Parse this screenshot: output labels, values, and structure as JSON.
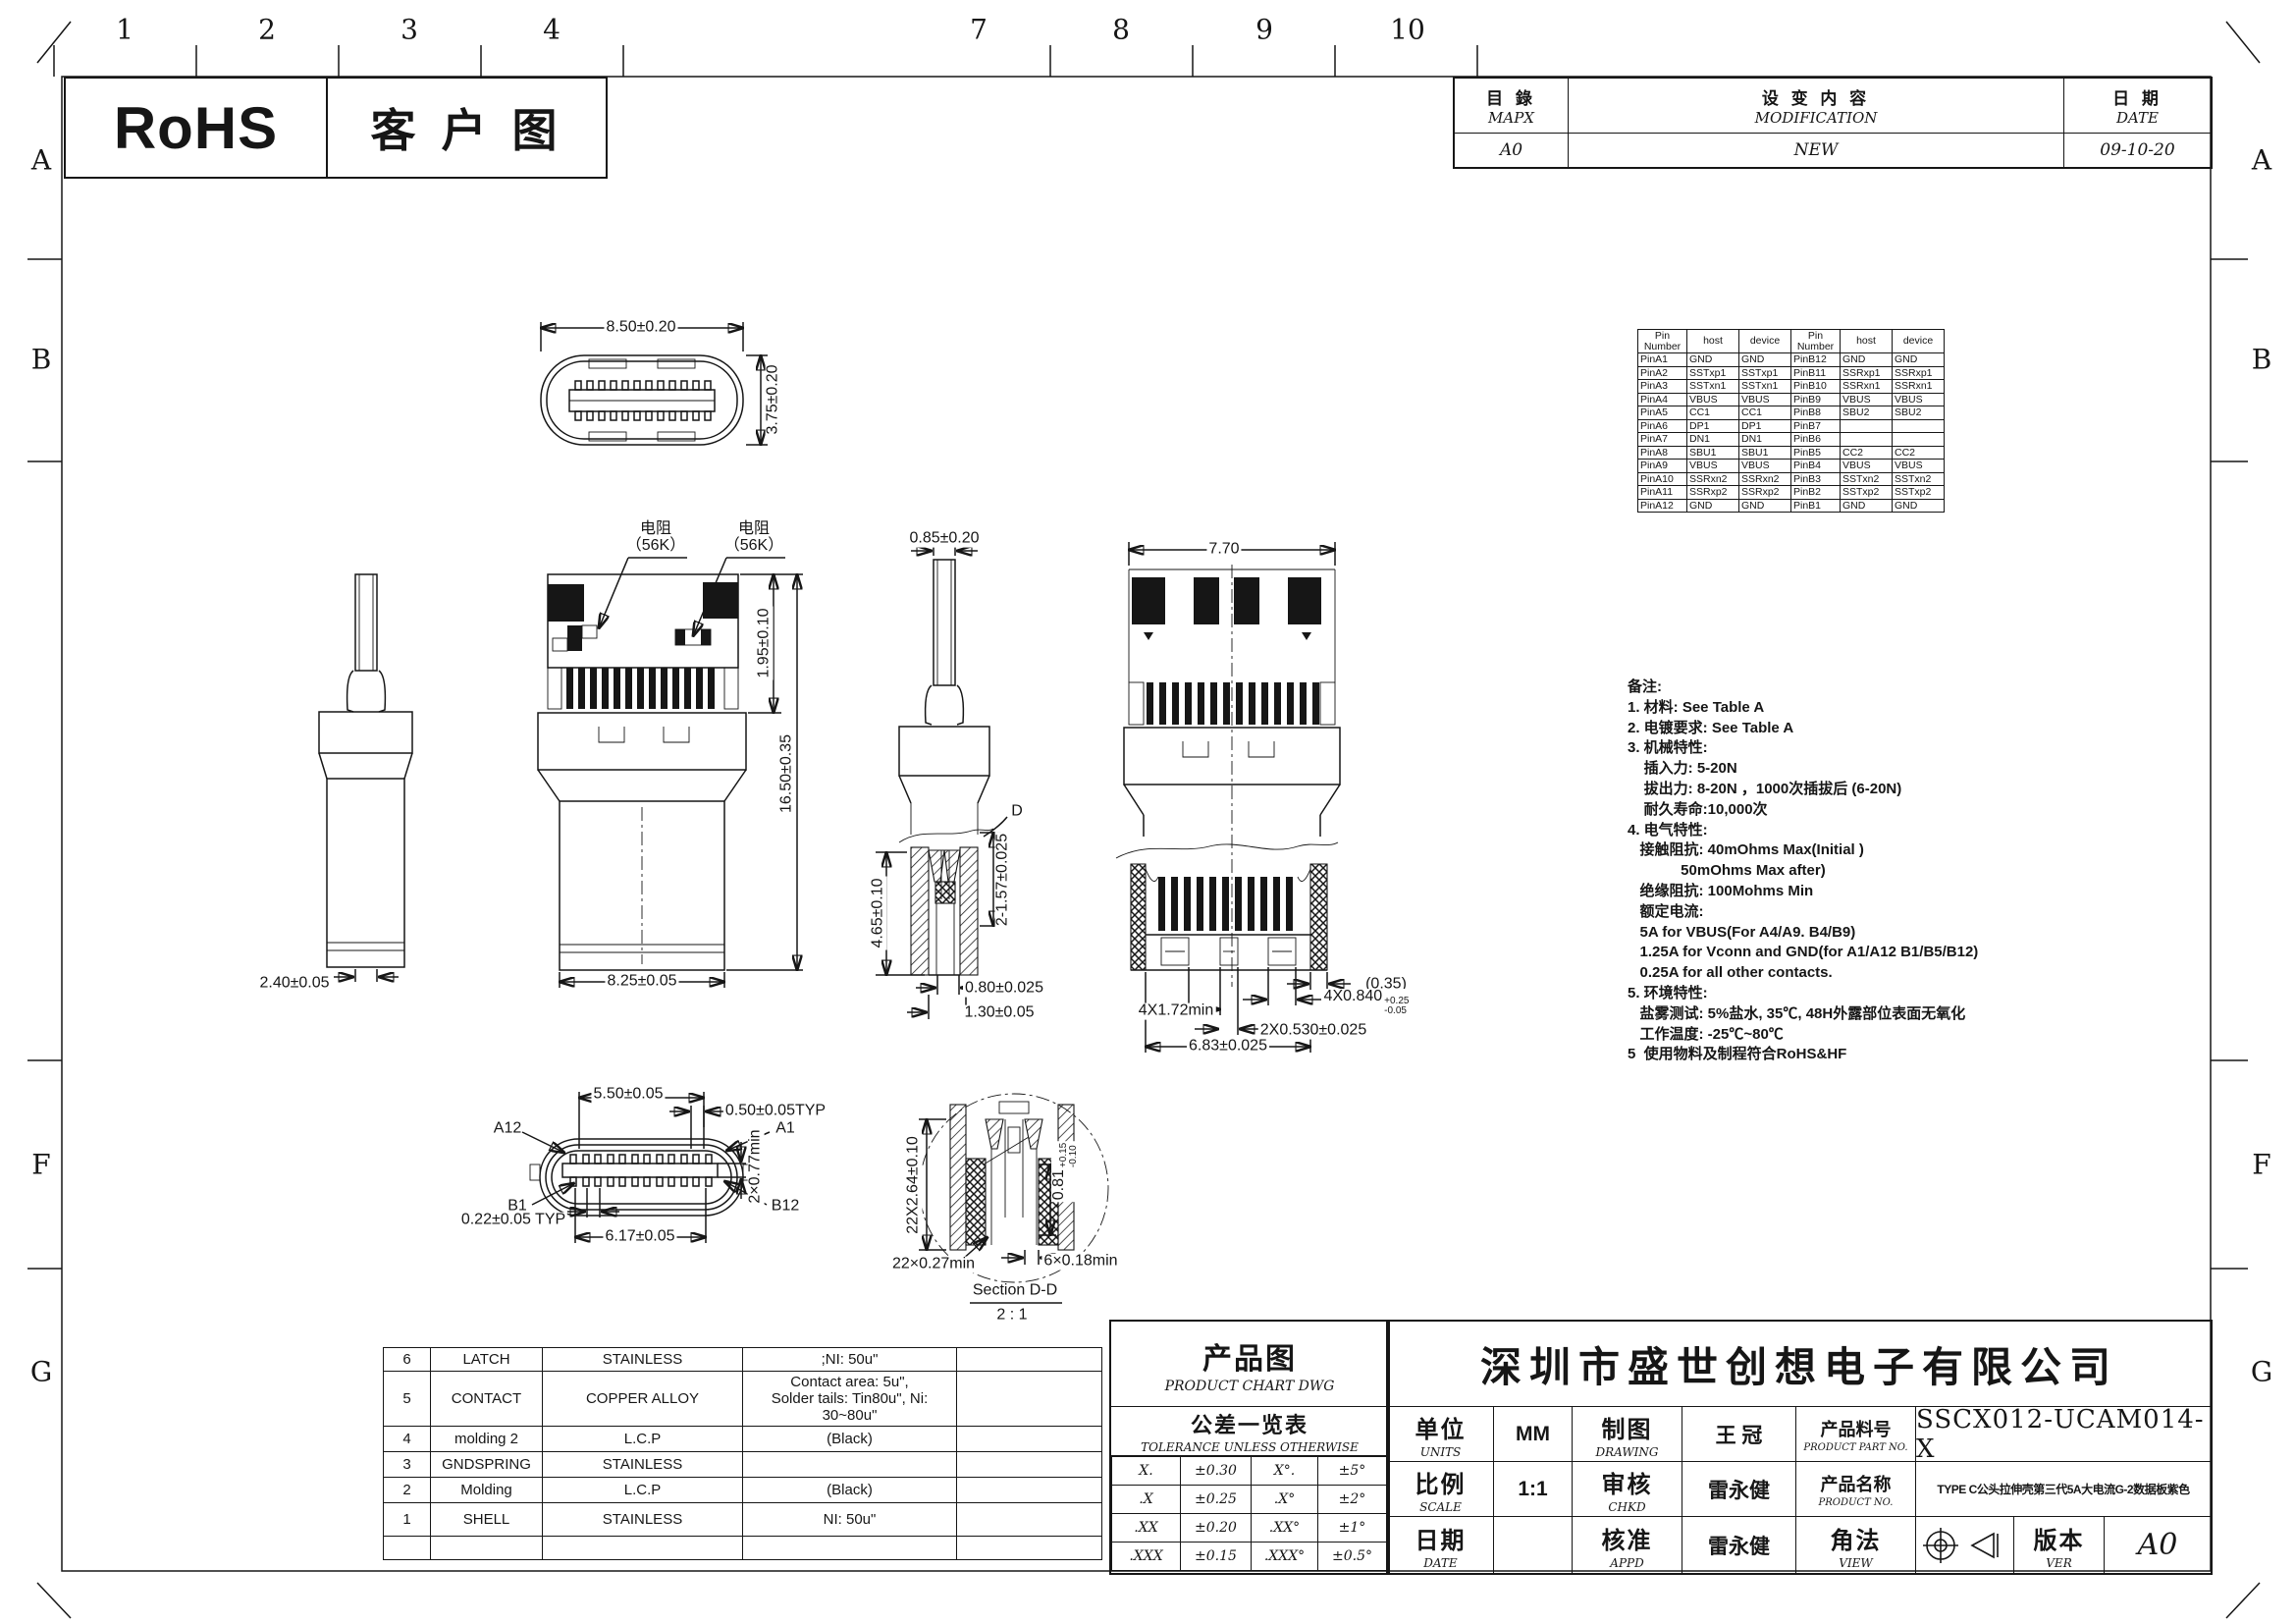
{
  "header": {
    "rohs": "RoHS",
    "customer_drawing": "客户图"
  },
  "ruler": {
    "top": [
      "1",
      "2",
      "3",
      "4",
      "7",
      "8",
      "9",
      "10"
    ],
    "left": [
      "A",
      "B",
      "F",
      "G"
    ],
    "right": [
      "A",
      "B",
      "F",
      "G"
    ]
  },
  "mod_table": {
    "cols": [
      {
        "zh": "目 錄",
        "en": "MAPX"
      },
      {
        "zh": "设 变 内 容",
        "en": "MODIFICATION"
      },
      {
        "zh": "日 期",
        "en": "DATE"
      }
    ],
    "row": [
      "A0",
      "NEW",
      "09-10-20"
    ]
  },
  "pin_table": {
    "headers": [
      "Pin\nNumber",
      "host",
      "device",
      "Pin\nNumber",
      "host",
      "device"
    ],
    "rows": [
      [
        "PinA1",
        "GND",
        "GND",
        "PinB12",
        "GND",
        "GND"
      ],
      [
        "PinA2",
        "SSTxp1",
        "SSTxp1",
        "PinB11",
        "SSRxp1",
        "SSRxp1"
      ],
      [
        "PinA3",
        "SSTxn1",
        "SSTxn1",
        "PinB10",
        "SSRxn1",
        "SSRxn1"
      ],
      [
        "PinA4",
        "VBUS",
        "VBUS",
        "PinB9",
        "VBUS",
        "VBUS"
      ],
      [
        "PinA5",
        "CC1",
        "CC1",
        "PinB8",
        "SBU2",
        "SBU2"
      ],
      [
        "PinA6",
        "DP1",
        "DP1",
        "PinB7",
        "",
        ""
      ],
      [
        "PinA7",
        "DN1",
        "DN1",
        "PinB6",
        "",
        ""
      ],
      [
        "PinA8",
        "SBU1",
        "SBU1",
        "PinB5",
        "CC2",
        "CC2"
      ],
      [
        "PinA9",
        "VBUS",
        "VBUS",
        "PinB4",
        "VBUS",
        "VBUS"
      ],
      [
        "PinA10",
        "SSRxn2",
        "SSRxn2",
        "PinB3",
        "SSTxn2",
        "SSTxn2"
      ],
      [
        "PinA11",
        "SSRxp2",
        "SSRxp2",
        "PinB2",
        "SSTxp2",
        "SSTxp2"
      ],
      [
        "PinA12",
        "GND",
        "GND",
        "PinB1",
        "GND",
        "GND"
      ]
    ]
  },
  "notes": {
    "lines": [
      "备注:",
      "1. 材料: See Table A",
      "2. 电镀要求: See Table A",
      "3. 机械特性:",
      "    插入力: 5-20N",
      "    拔出力: 8-20N ，1000次插拔后 (6-20N)",
      "    耐久寿命:10,000次",
      "4. 电气特性:",
      "   接触阻抗: 40mOhms Max(Initial )",
      "             50mOhms Max after)",
      "   绝缘阻抗: 100Mohms Min",
      "   额定电流:",
      "   5A for VBUS(For A4/A9. B4/B9)",
      "   1.25A for Vconn and GND(for A1/A12 B1/B5/B12)",
      "   0.25A for all other contacts.",
      "5. 环境特性:",
      "   盐雾测试: 5%盐水, 35℃, 48H外露部位表面无氧化",
      "   工作温度: -25℃~80℃",
      "5  使用物料及制程符合RoHS&HF"
    ]
  },
  "dims": {
    "a_w": "8.50±0.20",
    "a_h": "3.75±0.20",
    "res_zh": "电阻",
    "res_val": "（56K）",
    "c_pcb": "1.95±0.10",
    "c_total": "16.50±0.35",
    "b_w": "2.40±0.05",
    "c_w": "8.25±0.05",
    "d_stem": "0.85±0.20",
    "e_w": "7.70",
    "d_callout": "D",
    "d_h": "4.65±0.10",
    "d_h2": "2-1.57±0.025",
    "d_w1": "0.80±0.025",
    "d_w2": "1.30±0.05",
    "f_035": "(0.35)",
    "f_0840": "4X0.840",
    "f_0840_sup": "+0.25",
    "f_0840_sub": "-0.05",
    "f_172": "4X1.72min",
    "f_0530": "2X0.530±0.025",
    "f_683": "6.83±0.025",
    "g_550": "5.50±0.05",
    "g_050": "0.50±0.05TYP",
    "g_077": "2×0.77min",
    "g_022": "0.22±0.05 TYP",
    "g_617": "6.17±0.05",
    "pin_a12": "A12",
    "pin_a1": "A1",
    "pin_b1": "B1",
    "pin_b12": "B12",
    "h_264": "22X2.64±0.10",
    "h_081": "0.81",
    "h_081_sup": "+0.15",
    "h_081_sub": "-0.10",
    "h_027": "22×0.27min",
    "h_018": "6×0.18min",
    "section_label": "Section D-D",
    "section_scale": "2 : 1"
  },
  "parts_table": {
    "rows": [
      [
        "6",
        "LATCH",
        "STAINLESS",
        ";NI: 50u\"",
        ""
      ],
      [
        "5",
        "CONTACT",
        "COPPER ALLOY",
        "Contact area: 5u\",\nSolder tails: Tin80u\", Ni: 30~80u\"",
        ""
      ],
      [
        "4",
        "molding 2",
        "L.C.P",
        "(Black)",
        ""
      ],
      [
        "3",
        "GNDSPRING",
        "STAINLESS",
        "",
        ""
      ],
      [
        "2",
        "Molding",
        "L.C.P",
        "(Black)",
        ""
      ],
      [
        "1",
        "SHELL",
        "STAINLESS",
        "NI: 50u\"",
        ""
      ],
      [
        "",
        "",
        "",
        "",
        ""
      ]
    ]
  },
  "title_block": {
    "product_chart_zh": "产品图",
    "product_chart_en": "PRODUCT CHART DWG",
    "tolerance_zh": "公差一览表",
    "tolerance_en": "TOLERANCE UNLESS OTHERWISE",
    "tolerance_rows": [
      [
        "X.",
        "±0.30",
        "X°.",
        "±5°"
      ],
      [
        ".X",
        "±0.25",
        ".X°",
        "±2°"
      ],
      [
        ".XX",
        "±0.20",
        ".XX°",
        "±1°"
      ],
      [
        ".XXX",
        "±0.15",
        ".XXX°",
        "±0.5°"
      ]
    ],
    "company": "深圳市盛世创想电子有限公司",
    "units_zh": "单位",
    "units_en": "UNITS",
    "units_val": "MM",
    "drawing_zh": "制图",
    "drawing_en": "DRAWING",
    "drawing_val": "王 冠",
    "part_no_zh": "产品料号",
    "part_no_en": "PRODUCT PART NO.",
    "part_no_val": "SSCX012-UCAM014-X",
    "scale_zh": "比例",
    "scale_en": "SCALE",
    "scale_val": "1:1",
    "chkd_zh": "审核",
    "chkd_en": "CHKD",
    "chkd_val": "雷永健",
    "name_zh": "产品名称",
    "name_en": "PRODUCT NO.",
    "name_val": "TYPE C公头拉伸壳第三代5A大电流G-2数据板紫色",
    "date_zh": "日期",
    "date_en": "DATE",
    "date_val": "",
    "appd_zh": "核准",
    "appd_en": "APPD",
    "appd_val": "雷永健",
    "view_zh": "角法",
    "view_en": "VIEW",
    "ver_zh": "版本",
    "ver_en": "VER",
    "ver_val": "A0"
  }
}
